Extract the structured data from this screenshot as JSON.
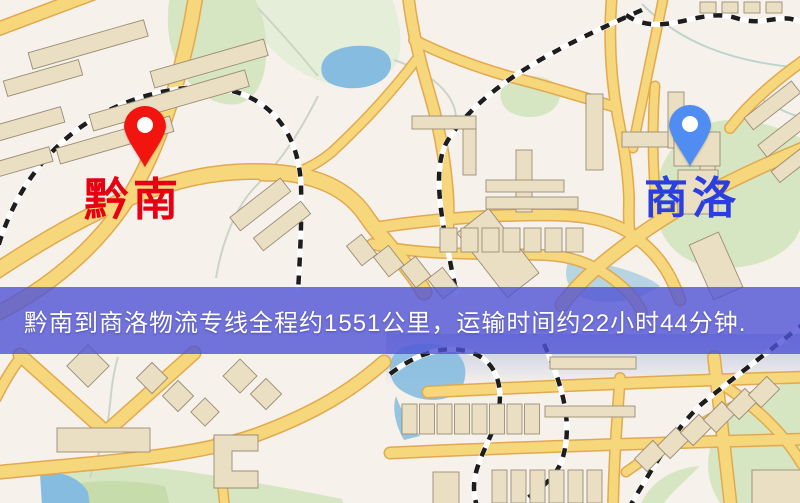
{
  "map": {
    "origin": {
      "label": "黔南",
      "label_color": "#e60012",
      "pin_color": "#f2150f"
    },
    "destination": {
      "label": "商洛",
      "label_color": "#2b3fe0",
      "pin_color": "#4f8df2"
    }
  },
  "banner": {
    "text": "黔南到商洛物流专线全程约1551公里，运输时间约22小时44分钟.",
    "bg_color": "rgba(79,82,214,0.8)",
    "text_color": "#ffffff"
  },
  "route": {
    "origin": "黔南",
    "destination": "商洛",
    "distance_text": "约1551公里",
    "duration_text": "约22小时44分钟"
  },
  "palette": {
    "background": "#f7f1ec",
    "road_fill": "#f6d77c",
    "road_casing": "#e2a94f",
    "building": "#eadfc2",
    "building_outline": "#998d76",
    "park": "#d6e6c2",
    "water": "#86bcdf",
    "railway_dark": "#1d1d1d",
    "railway_light": "#ffffff"
  }
}
